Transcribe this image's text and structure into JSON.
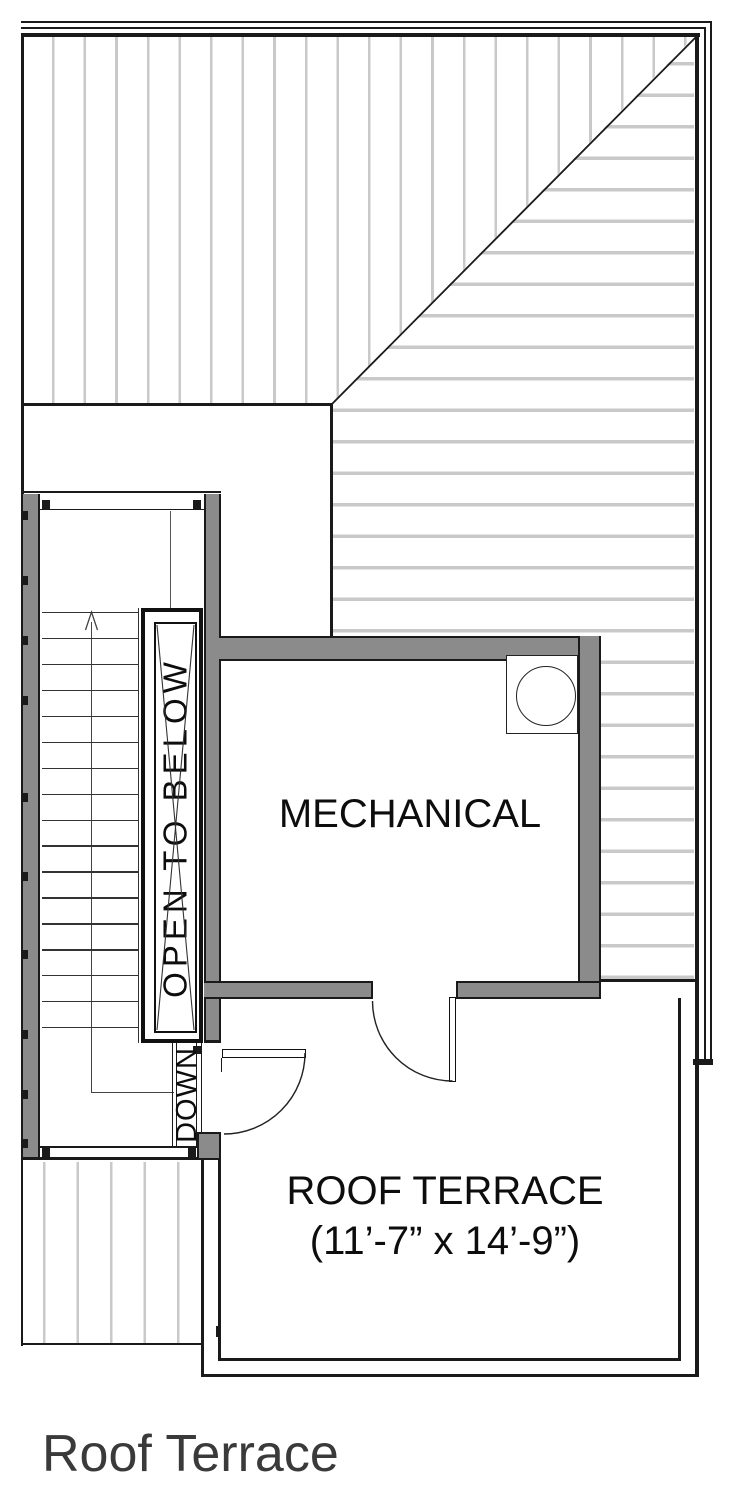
{
  "title": "Roof Terrace",
  "plan": {
    "labels": {
      "mechanical": "MECHANICAL",
      "roof_terrace": "ROOF TERRACE",
      "roof_terrace_dimensions": "(11’-7” x 14’-9”)",
      "open_to_below": "OPEN TO BELOW",
      "down": "DOWN"
    }
  },
  "colors": {
    "line_dark": "#1a1a1a",
    "wall_gray": "#8b8b8b",
    "hatch_gray": "#c9c9c9",
    "title_gray": "#3a3a3a"
  }
}
